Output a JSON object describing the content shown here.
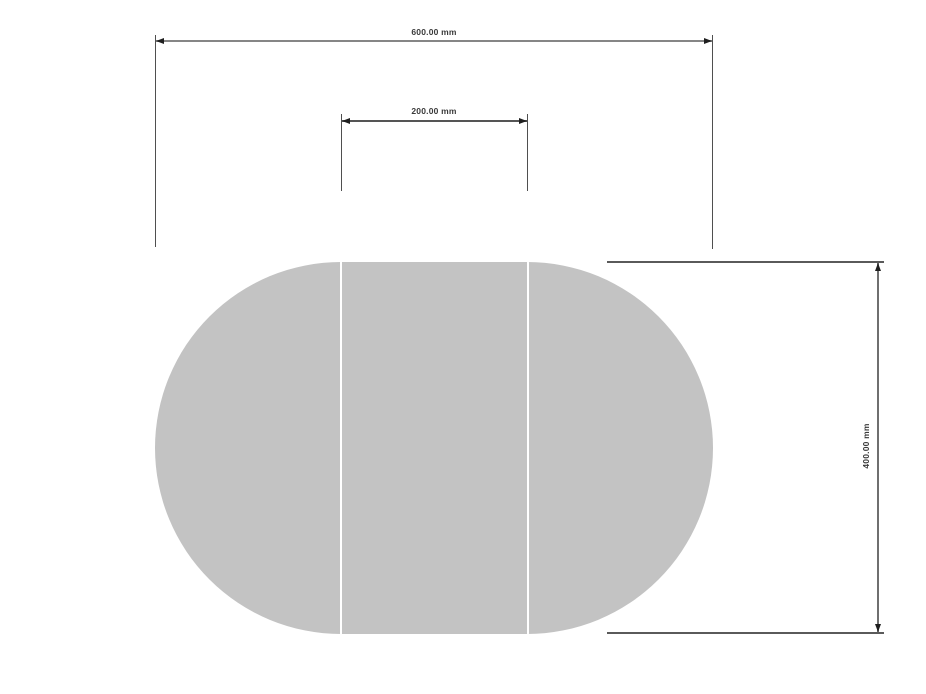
{
  "page": {
    "background_color": "#ffffff"
  },
  "drawing": {
    "type": "dimensioned technical drawing (plan view)",
    "shape": {
      "name": "oval table top with center extension leaf",
      "sections": 3,
      "fill_color": "#c3c3c3",
      "divider_color": "#ffffff"
    },
    "dimensions": [
      {
        "id": "overall_width",
        "label": "600.00 mm",
        "value": 600,
        "unit": "mm",
        "orientation": "horizontal"
      },
      {
        "id": "center_leaf_width",
        "label": "200.00 mm",
        "value": 200,
        "unit": "mm",
        "orientation": "horizontal"
      },
      {
        "id": "overall_height",
        "label": "400.00 mm",
        "value": 400,
        "unit": "mm",
        "orientation": "vertical"
      }
    ],
    "colors": {
      "dimension_line": "#868686",
      "extension_line": "#4f4f4f",
      "arrowhead": "#1f1f1f",
      "label_text": "#3a3a3a"
    }
  }
}
